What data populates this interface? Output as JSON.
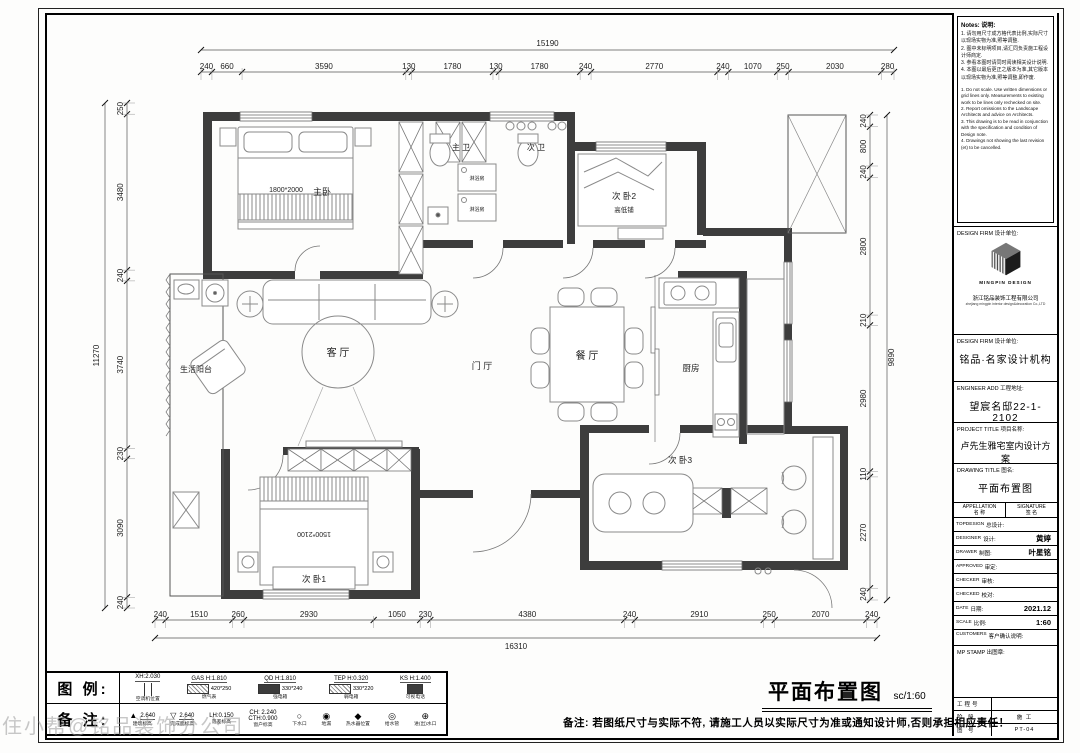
{
  "watermark": "住小帮@铭品装饰分公司",
  "plan": {
    "labels": {
      "master": "主卧",
      "master_bed": "1800*2000",
      "bath1": "主 卫",
      "bath2": "次 卫",
      "shower1": "淋浴房",
      "shower2": "淋浴房",
      "bed2": "次 卧2",
      "bunk": "高低铺",
      "balcony": "生活阳台",
      "living": "客 厅",
      "hall": "门 厅",
      "dining": "餐 厅",
      "kitchen": "厨房",
      "bed1": "次 卧1",
      "bed1_size": "1500*2100",
      "bed3": "次 卧3"
    },
    "dims": {
      "top": {
        "overall": "15190",
        "segments": [
          "240",
          "660",
          "3590",
          "130",
          "1780",
          "130",
          "1780",
          "240",
          "2770",
          "240",
          "1070",
          "250",
          "2030",
          "280"
        ]
      },
      "bottom": {
        "overall": "16310",
        "segments": [
          "240",
          "1510",
          "260",
          "2930",
          "1050",
          "230",
          "4380",
          "240",
          "2910",
          "250",
          "2070",
          "240"
        ]
      },
      "left": {
        "overall": "11270",
        "segments": [
          "250",
          "3480",
          "240",
          "3740",
          "230",
          "3090",
          "240"
        ]
      },
      "right": {
        "overall": "9890",
        "segments": [
          "240",
          "800",
          "240",
          "2800",
          "210",
          "2980",
          "110",
          "2270",
          "240"
        ]
      }
    }
  },
  "titleblock": {
    "notes_title": "Notes: 说明:",
    "notes_cn": [
      "1. 请勿用尺寸成方格代表比例,实际尺寸以现场实物为准,照等调整.",
      "2. 图中未标明项目,请汇同负责施工程设计师商定.",
      "3. 参看本图时请同时阅读相关设计说明.",
      "4. 本图以最后更正之版本为准,其它版本以现场实物为准,照等调整,即作废."
    ],
    "notes_en": [
      "1. Do not scale. Use written dimensions or grid lines only. Measurements to existing work to be lines only rechecked on site.",
      "2. Report omissions to the Landscape Architects and advice on Architects.",
      "3. This drawing is to be read in conjunction with the specification and condition of Design note.",
      "4. Drawings not showing the last revision (et) to be cancelled."
    ],
    "design_firm_label": "DESIGN FIRM",
    "design_firm_cn": "设计单位:",
    "logo_text": "MINGPIN DESIGN",
    "company_cn": "浙江铭品装饰工程有限公司",
    "company_en": "zhejiang mingpin interior design&decoration Co.,LTD",
    "firm": {
      "label": "DESIGN FIRM 设计单位:",
      "value": "铭品·名家设计机构"
    },
    "addr": {
      "label": "ENGINEER ADD 工程地址:",
      "value": "望宸名邸22-1-2102"
    },
    "project": {
      "label": "PROJECT TITLE 项目名称:",
      "value": "卢先生雅宅室内设计方案"
    },
    "drawing": {
      "label": "DRAWING TITLE 图名:",
      "value": "平面布置图"
    },
    "sig_header": {
      "left_en": "APPELLATION",
      "left_cn": "名 称",
      "right_en": "SIGNATURE",
      "right_cn": "签 名"
    },
    "sig_rows": [
      {
        "en": "TOPDESIGN",
        "cn": "总设计:",
        "value": ""
      },
      {
        "en": "DESIGNER",
        "cn": "设计:",
        "value": "黄婷"
      },
      {
        "en": "DRAWER",
        "cn": "制图:",
        "value": "叶星铭"
      },
      {
        "en": "APPROVED",
        "cn": "审定:",
        "value": ""
      },
      {
        "en": "CHECKER",
        "cn": "审核:",
        "value": ""
      },
      {
        "en": "CHECKED",
        "cn": "校对:",
        "value": ""
      },
      {
        "en": "DATE",
        "cn": "日期:",
        "value": "2021.12"
      },
      {
        "en": "SCALE",
        "cn": "比例:",
        "value": "1:60"
      },
      {
        "en": "CUSTOMERS",
        "cn": "客户确认说明:",
        "value": ""
      }
    ],
    "stamp": "MP STAMP 出图章:",
    "mini_rows": [
      {
        "label": "工程号",
        "value": ""
      },
      {
        "label": "阶 段",
        "value": "施 工"
      },
      {
        "label": "图 号",
        "value": "PT-04"
      }
    ]
  },
  "legend": {
    "legend_label": "图 例:",
    "remark_label": "备 注:",
    "row1": [
      {
        "value": "XH:2.030",
        "size": "",
        "label": "空调机位置",
        "sym": "ac"
      },
      {
        "value": "GAS H:1.810",
        "size": "420*250",
        "label": "燃气表",
        "sym": "hatchbox"
      },
      {
        "value": "QD H:1.810",
        "size": "330*240",
        "label": "强电箱",
        "sym": "darkbox"
      },
      {
        "value": "TEP H:0.320",
        "size": "330*220",
        "label": "弱电箱",
        "sym": "hatchbox"
      },
      {
        "value": "KS H:1.400",
        "size": "",
        "label": "可视电话",
        "sym": "darkbox-small"
      }
    ],
    "row2": [
      {
        "value": "2.640",
        "value2": "",
        "label": "建筑标高",
        "sym": "tri-filled"
      },
      {
        "value": "2.640",
        "value2": "",
        "label": "完成面标高",
        "sym": "tri-open"
      },
      {
        "value": "LH:0.150",
        "value2": "",
        "label": "落差标高",
        "sym": "none"
      },
      {
        "value": "CH: 2.240",
        "value2": "CTH:0.900",
        "label": "窗户标高",
        "sym": "none"
      },
      {
        "value": "",
        "value2": "",
        "label": "下水口",
        "sym": "circle-open"
      },
      {
        "value": "",
        "value2": "",
        "label": "地漏",
        "sym": "circle-dot"
      },
      {
        "value": "",
        "value2": "",
        "label": "热水器位置",
        "sym": "diamond"
      },
      {
        "value": "",
        "value2": "",
        "label": "给水管",
        "sym": "circle-c"
      },
      {
        "value": "",
        "value2": "",
        "label": "进(出)水口",
        "sym": "valve"
      }
    ]
  },
  "footer": {
    "title": "平面布置图",
    "scale": "sc/1:60",
    "remark": "备注: 若图纸尺寸与实际不符, 请施工人员以实际尺寸为准或通知设计师,否则承担相应责任！"
  }
}
